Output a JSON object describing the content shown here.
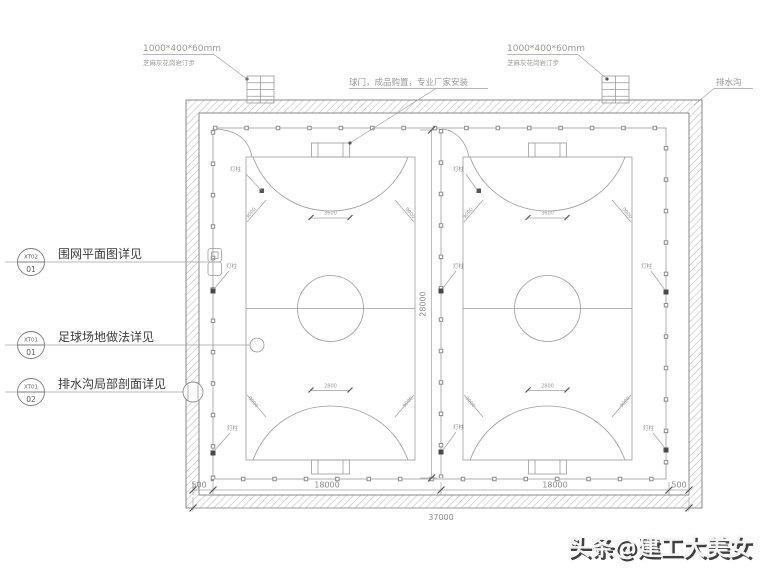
{
  "annotations": {
    "paver": {
      "size": "1000*400*60mm",
      "material": "芝麻灰花岗岩汀步"
    },
    "goal_note": "球门，成品购置，专业厂家安装",
    "drain": "排水沟"
  },
  "callouts": [
    {
      "code": "XT02",
      "num": "01",
      "label": "围网平面图详见"
    },
    {
      "code": "XT01",
      "num": "01",
      "label": "足球场地做法详见"
    },
    {
      "code": "XT01",
      "num": "02",
      "label": "排水沟局部剖面详见"
    }
  ],
  "dimensions": {
    "bottom": {
      "left": "500",
      "span1": "18000",
      "span2": "18000",
      "right": "500",
      "total": "37000"
    },
    "height_total": "28000",
    "goal_top": "3600",
    "goal_bottom": "2800",
    "arc_radius": "9000"
  },
  "labels": {
    "lamp_post": "灯柱"
  },
  "watermark": "头条@建工大美女",
  "colors": {
    "line": "#9b9b9b",
    "dark": "#555555",
    "hatch": "#bcbcbc",
    "label_text": "#3a3a3a"
  }
}
